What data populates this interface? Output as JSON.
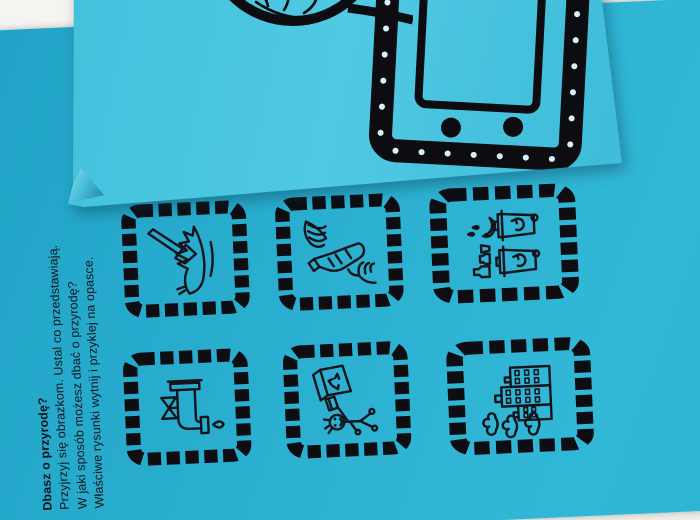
{
  "scene": {
    "description": "photo of a cyan eco-education worksheet partially covered by a second cyan sheet with a paper wristwatch craft template",
    "background_color": "#f5f3ef"
  },
  "worksheet": {
    "paper_color": "#2bb0d1",
    "ink_color": "#15151b",
    "instructions": {
      "line1": "Dbasz o przyrodę?",
      "line2": "Przyjrzyj się obrazkom. Ustal co przedstawiają.",
      "line3": "W jaki sposób możesz dbać o przyrodę?",
      "line4": "Właściwe rysunki wytnij i przyklej na opasce."
    },
    "pictures": [
      {
        "name": "axe-chopping-fallen-tree"
      },
      {
        "name": "hands-crushing-plastic-bottle"
      },
      {
        "name": "waste-sorted-into-recycling-bins"
      },
      {
        "name": "dripping-water-tap"
      },
      {
        "name": "child-throwing-box-into-recycling-bin"
      },
      {
        "name": "factory-buildings-with-smoke"
      }
    ],
    "frame_style": "black dashed film-strip squares"
  },
  "overlay_sheet": {
    "paper_color": "#49c4de",
    "drawing": "paper-watch-wristband-template",
    "parts": [
      "watch-face-circle-with-plant-sketch",
      "watch-band-black-frame-with-white-dots",
      "inner-screen-rectangle",
      "two-snap-dots"
    ]
  }
}
